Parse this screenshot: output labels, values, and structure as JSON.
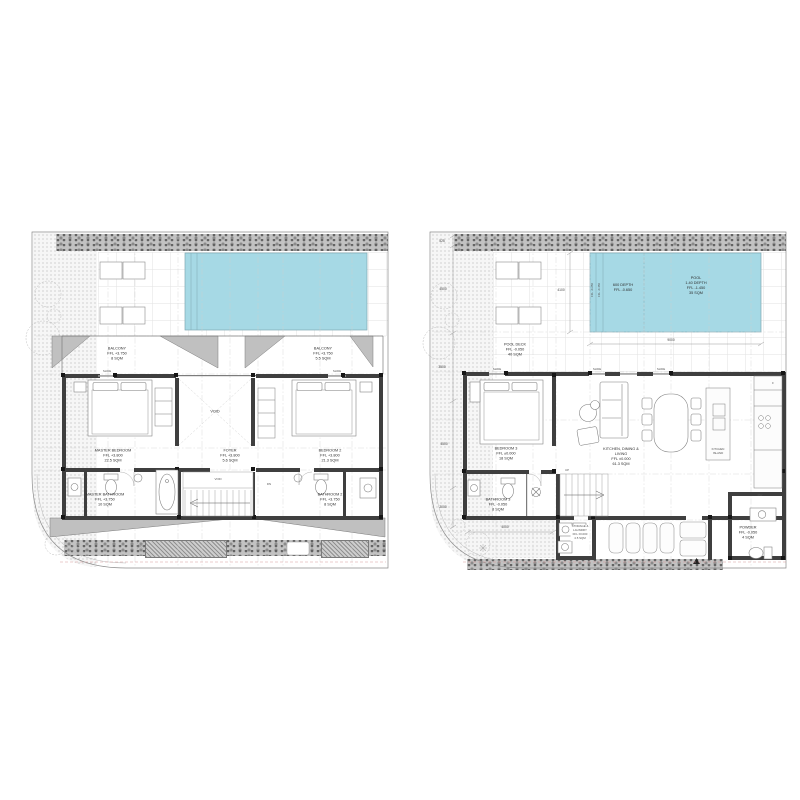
{
  "drawing": {
    "kind": "villa floor plans",
    "colors": {
      "pool": "#a6d9e5",
      "roof": "#c0c0c0",
      "wall": "#3f3f3f",
      "setback_line": "#d89a9a"
    }
  },
  "upper_floor_plan": {
    "balcony_1": "BALCONY\nFFL +3.750\n8 SQM",
    "balcony_2": "BALCONY\nFFL +3.750\n5.5 SQM",
    "master_bedroom": "MASTER BEDROOM\nFFL +3.800\n22.5 SQM",
    "foyer": "FOYER\nFFL +3.800\n5.6 SQM",
    "bedroom_2": "BEDROOM 2\nFFL +3.800\n21.3 SQM",
    "master_bathroom": "MASTER BATHROOM\nFFL +3.750\n10 SQM",
    "bathroom_2": "BATHROOM 2\nFFL +3.750\n8 SQM",
    "void_upper": "VOID",
    "void_stair": "VOID",
    "stair_direction": "DN",
    "slide_door_left": "SLIDE",
    "slide_door_right": "SLIDE"
  },
  "ground_floor_plan": {
    "pool": "POOL\n1.40 DEPTH\nFFL -1.450\n35 SQM",
    "pool_shallow": "600 DEPTH\nFFL -0.650",
    "pool_step_1": "FFL -0.250",
    "pool_step_2": "FFL -0.450",
    "pool_deck": "POOL DECK\nFFL -0.050\n40 SQM",
    "bedroom_3": "BEDROOM 3\nFFL ±0.000\n18 SQM",
    "kitchen_dining_living": "KITCHEN, DINING &\nLIVING\nFFL ±0.000\n61.3 SQM",
    "kitchen_island": "KITCHEN\nISLAND",
    "bathroom_3": "BATHROOM 3\nFFL -0.050\n8 SQM",
    "storage_laundry": "STORAGE &\nLAUNDRY\nFFL ±0.000\n4.5 SQM",
    "powder": "POWDER\nFFL -0.050\n4 SQM",
    "stair_direction": "UP",
    "fridge": "F",
    "dishwasher": "DW",
    "slide_doors": [
      "SLIDE",
      "SLIDE",
      "SLIDE"
    ],
    "dimensions": {
      "left": [
        "525",
        "4500",
        "3500",
        "4500",
        "2000"
      ],
      "pool_width": "4100",
      "pool_length": "9000",
      "garden": "4000"
    }
  }
}
